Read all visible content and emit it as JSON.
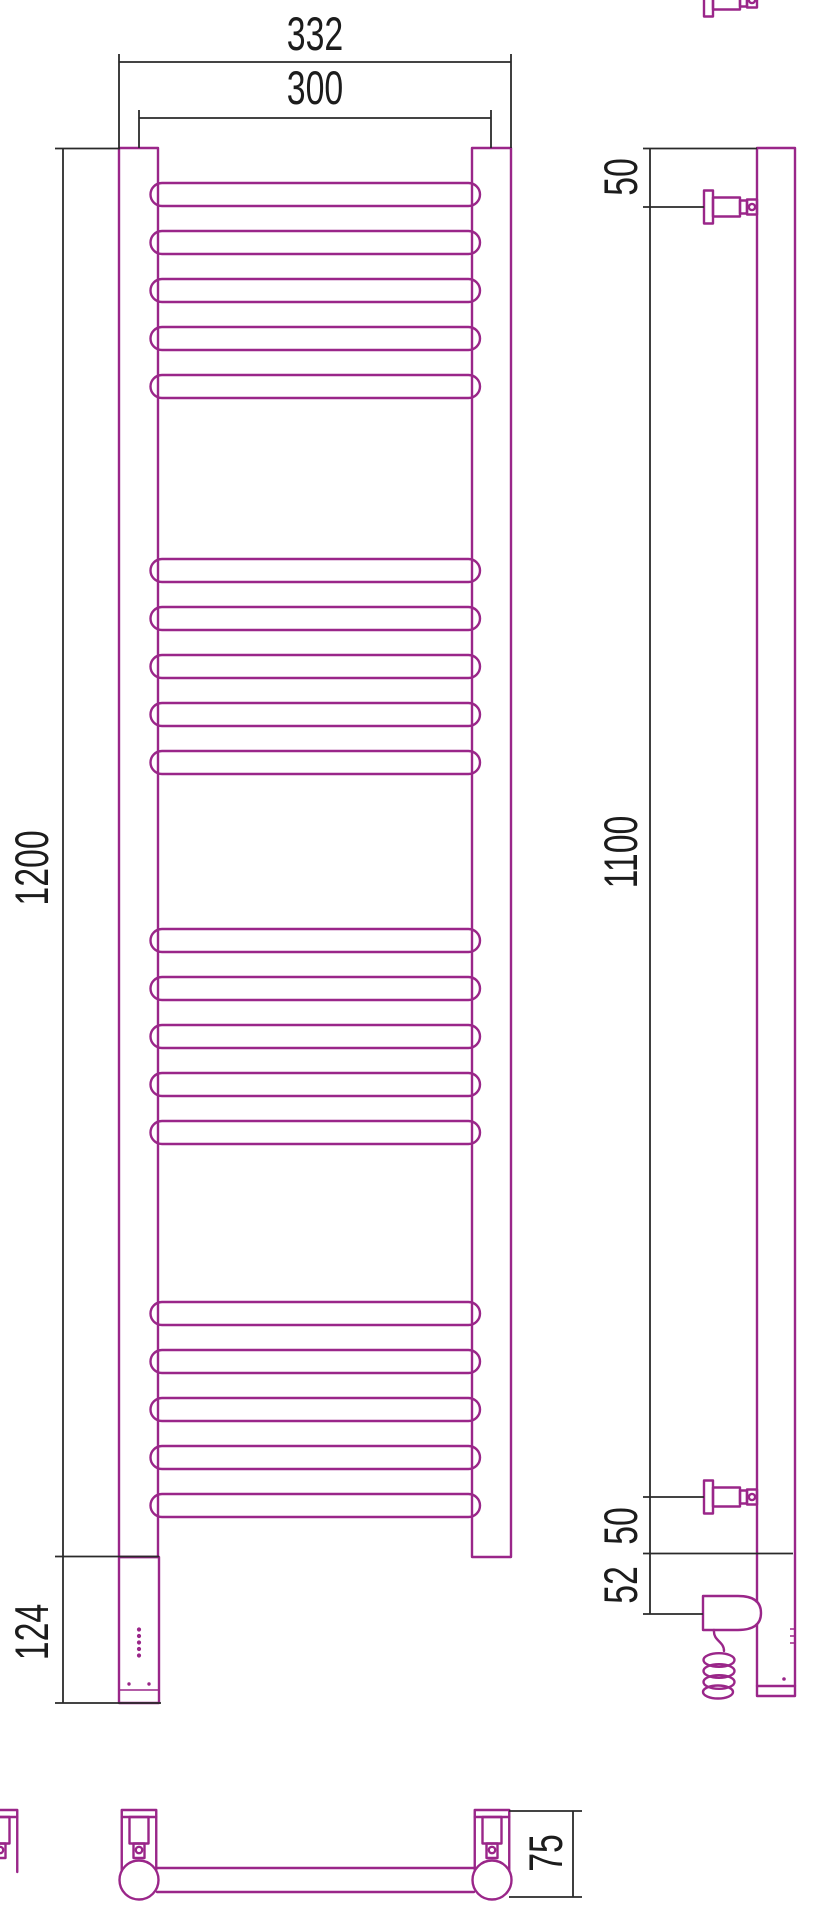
{
  "meta": {
    "drawing_type": "product technical drawing",
    "subject": "electric ladder towel rail — front, side and bottom orthographic views",
    "units": "mm"
  },
  "colors": {
    "product_outline": "#9A2689",
    "dimension_line": "#2A2A2A",
    "text": "#1C1C1C",
    "background": "#FFFFFF"
  },
  "views": {
    "front": {
      "label": "front-view",
      "dimensions": {
        "overall_width": "332",
        "post_center_width": "300",
        "rail_height": "1200",
        "housing_height": "124"
      },
      "rungs": {
        "groups": 4,
        "rungs_per_group": 5,
        "total": 20
      },
      "indicator_dots": {
        "column_count": 5,
        "pair_count": 2
      }
    },
    "side": {
      "label": "side-view",
      "dimensions": {
        "top_bracket_offset": "50",
        "bracket_span": "1100",
        "bottom_bracket_offset": "50",
        "heater_offset": "52"
      }
    },
    "bottom": {
      "label": "bottom-view",
      "dimensions": {
        "wall_depth": "75"
      }
    }
  },
  "geometry": {
    "rung_group_start_y": [
      183,
      559,
      929,
      1302
    ],
    "rung_pitch": 48,
    "rung_height": 23,
    "rung_x": 150.5,
    "rung_width": 329.5,
    "rung_radius": 11.5,
    "dot_column": {
      "x": 139,
      "start_y": 1629.5,
      "gap": 6.5,
      "r": 2.1
    },
    "dot_pair": {
      "y": 1684,
      "x1": 129,
      "x2": 149,
      "r": 1.7
    }
  }
}
